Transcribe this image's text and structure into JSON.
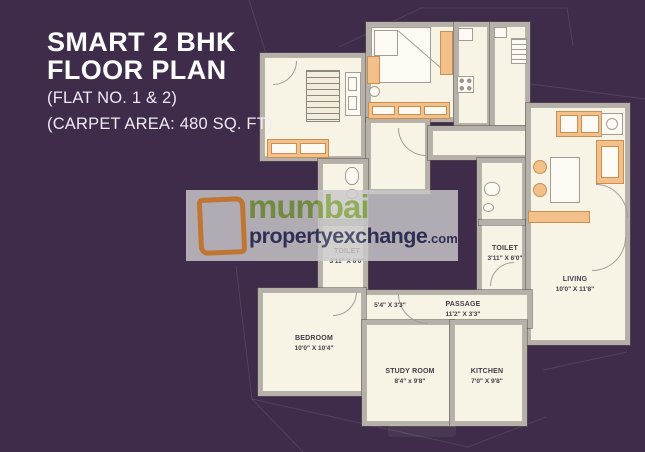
{
  "title": {
    "heading_line1": "SMART 2 BHK",
    "heading_line2": "FLOOR PLAN",
    "flat_no": "(FLAT NO. 1 & 2)",
    "carpet_area": "(CARPET AREA: 480 SQ. FT)"
  },
  "watermark": {
    "city": "mumbai",
    "brand": "propertyexchange",
    "tld": ".com"
  },
  "rooms": {
    "toilet_left": {
      "name": "TOILET",
      "dims": "3'11\" X 6'0\""
    },
    "toilet_right": {
      "name": "TOILET",
      "dims": "3'11\" X 6'0\""
    },
    "living": {
      "name": "LIVING",
      "dims": "10'0\" X 11'8\""
    },
    "passage": {
      "name": "PASSAGE",
      "dims": "11'2\" X 3'3\""
    },
    "passage_small": {
      "dims": "5'4\" X 3'3\""
    },
    "bedroom": {
      "name": "BEDROOM",
      "dims": "10'0\" X 10'4\""
    },
    "study_room": {
      "name": "STUDY ROOM",
      "dims": "8'4\" x 9'8\""
    },
    "kitchen": {
      "name": "KITCHEN",
      "dims": "7'0\" X 9'8\""
    }
  },
  "colors": {
    "background": "#3E2C4A",
    "floor": "#F7F3E5",
    "wall": "#B5B1AA",
    "furniture": "#F4C08A",
    "logo_orange": "#DD862F",
    "watermark_green": "#7D9F3E",
    "watermark_navy": "#2C2F55",
    "title_text": "#FFFFFF"
  }
}
